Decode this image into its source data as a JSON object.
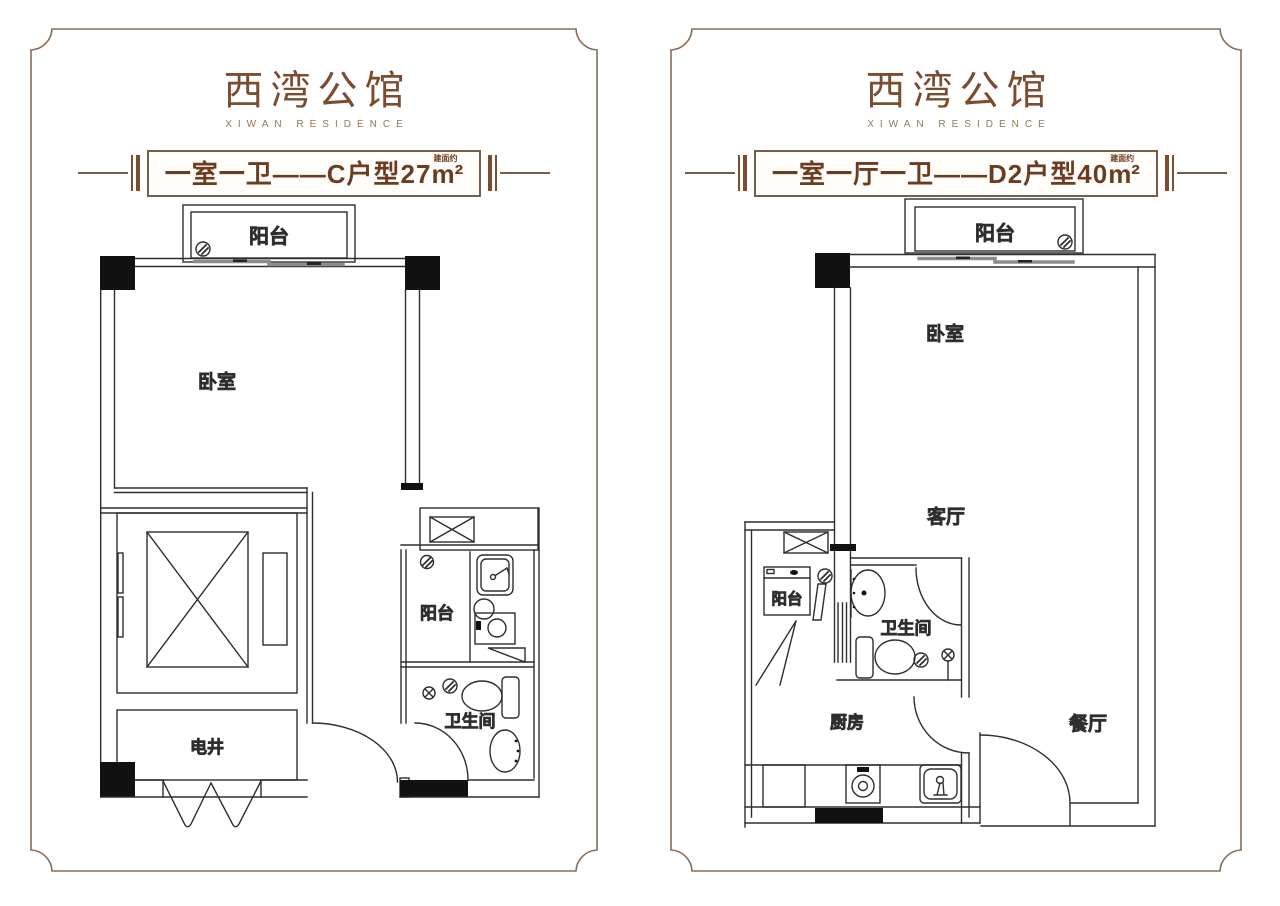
{
  "colors": {
    "frame_brown": "#8a6b54",
    "title_brown": "#7c4c30",
    "banner_text_brown": "#6b3c20",
    "plan_line": "#2e2e2e",
    "column_fill": "#111111",
    "sliding_door_gray": "#8c8c8c"
  },
  "panels": [
    {
      "title": "西湾公馆",
      "subtitle": "XIWAN RESIDENCE",
      "banner": {
        "label": "一室一卫——C户型27",
        "area_note": "建面约",
        "unit": "m²"
      },
      "rooms": {
        "balcony_top": "阳台",
        "bedroom": "卧室",
        "balcony_small": "阳台",
        "bathroom": "卫生间",
        "shaft": "电井"
      }
    },
    {
      "title": "西湾公馆",
      "subtitle": "XIWAN RESIDENCE",
      "banner": {
        "label": "一室一厅一卫——D2户型40",
        "area_note": "建面约",
        "unit": "m²"
      },
      "rooms": {
        "balcony_top": "阳台",
        "bedroom": "卧室",
        "living": "客厅",
        "balcony_small": "阳台",
        "bathroom": "卫生间",
        "kitchen": "厨房",
        "dining": "餐厅"
      }
    }
  ]
}
